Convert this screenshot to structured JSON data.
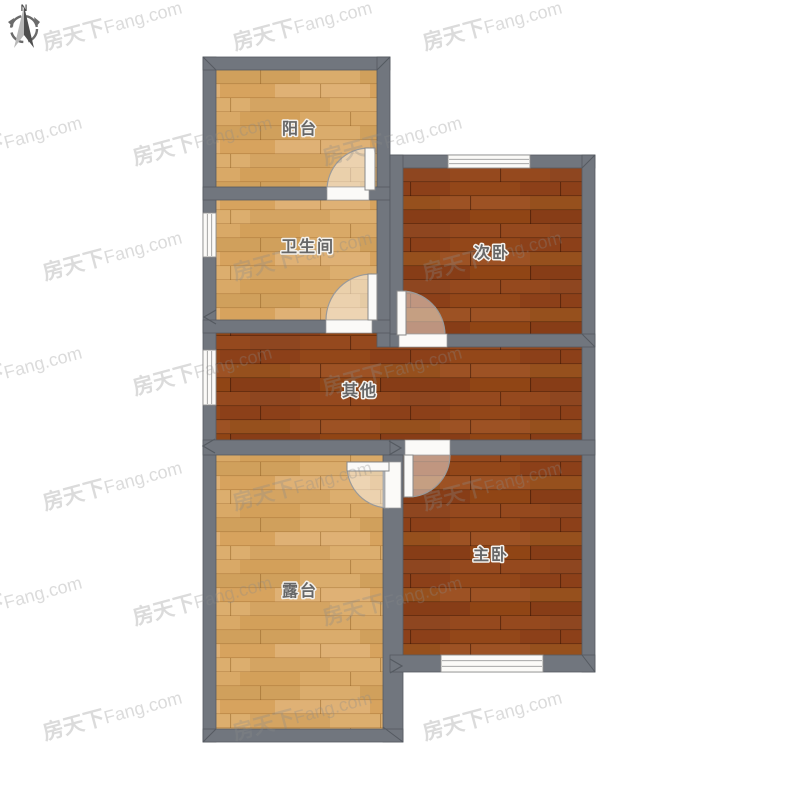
{
  "compass": {
    "north_label": "N"
  },
  "watermark": {
    "brand": "房天下",
    "domain": "Fang.com",
    "full_text": "房天下Fang.com"
  },
  "colors": {
    "background": "#ffffff",
    "wall": "#71767E",
    "wall_edge": "#555A61",
    "floor_light": "#D9A967",
    "floor_dark": "#95491E",
    "label_text": "#676767",
    "label_halo": "#f3f1ed",
    "door_white": "#FBFAF8",
    "watermark_gray": "#8a8a8a"
  },
  "rooms": [
    {
      "id": "balcony",
      "label": "阳台",
      "floor": "light"
    },
    {
      "id": "bathroom",
      "label": "卫生间",
      "floor": "light"
    },
    {
      "id": "second-bedroom",
      "label": "次卧",
      "floor": "dark"
    },
    {
      "id": "other",
      "label": "其他",
      "floor": "dark"
    },
    {
      "id": "master-bedroom",
      "label": "主卧",
      "floor": "dark"
    },
    {
      "id": "terrace",
      "label": "露台",
      "floor": "light"
    }
  ]
}
